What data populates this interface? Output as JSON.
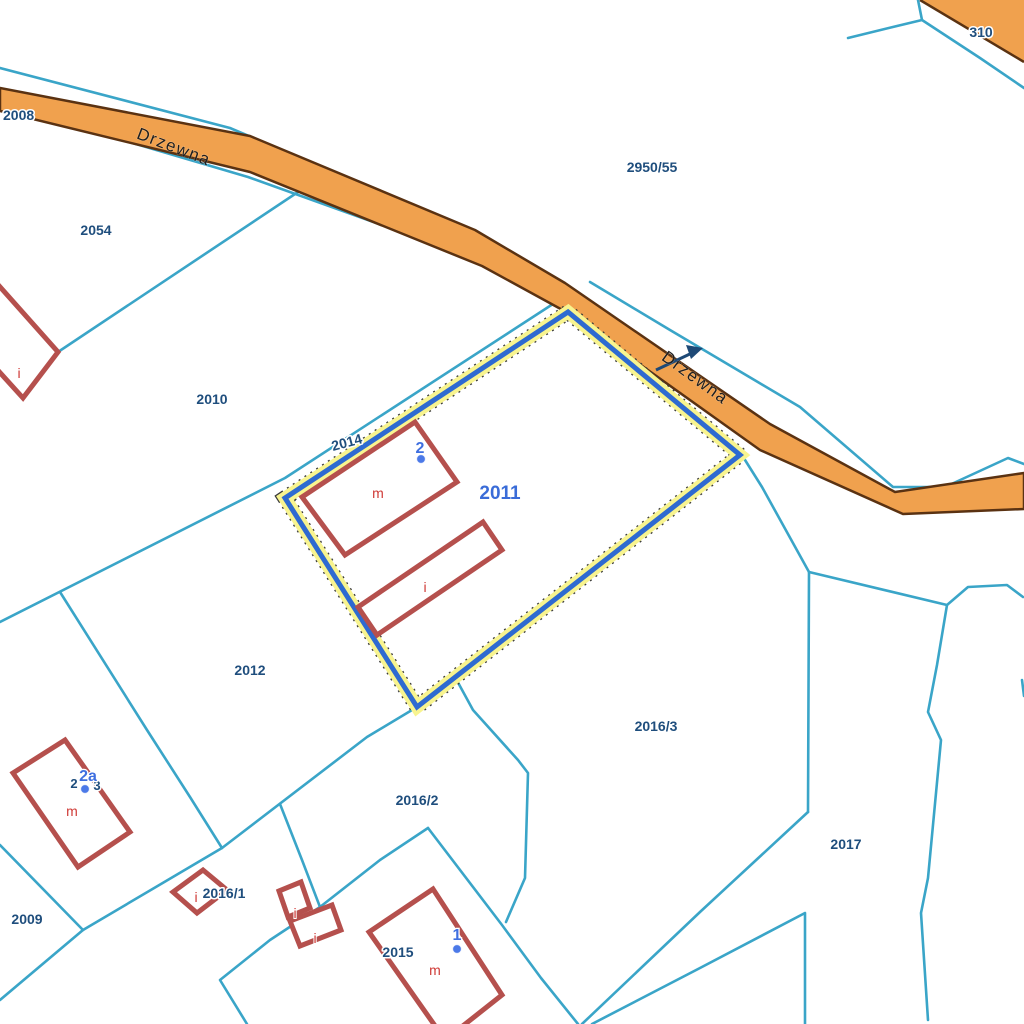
{
  "colors": {
    "boundary": "#3aa5c8",
    "road_fill": "#f0a14e",
    "road_edge": "#5a3212",
    "highlight_blue": "#2e6ad1",
    "highlight_halo": "#f8f48f",
    "highlight_dash": "#3a3a3a",
    "building": "#b5504d",
    "parcel_text": "#1f4e7d",
    "selected_text": "#3a6cd8",
    "address_text": "#3f6fe0",
    "address_dot": "#4b79e8",
    "building_text": "#cf3a36",
    "road_text": "#1f1f1f",
    "arrow": "#1e4976"
  },
  "roads": {
    "main_name": "Drzewna",
    "main_name_2": "Drzewna"
  },
  "selection": {
    "selected_parcel": "2011"
  },
  "parcels": {
    "p2008": "2008",
    "p2054": "2054",
    "p2010": "2010",
    "p2950_55": "2950/55",
    "p2014": "2014",
    "p2011": "2011",
    "p2012": "2012",
    "p2016_1": "2016/1",
    "p2016_2": "2016/2",
    "p2016_3": "2016/3",
    "p2017": "2017",
    "p2009": "2009",
    "p2015": "2015",
    "p310": "310",
    "frag_a": "2",
    "frag_b": "3"
  },
  "addresses": {
    "a2": "2",
    "a2a": "2a",
    "a1": "1"
  },
  "buildings": {
    "residential": "m",
    "other": "i"
  }
}
